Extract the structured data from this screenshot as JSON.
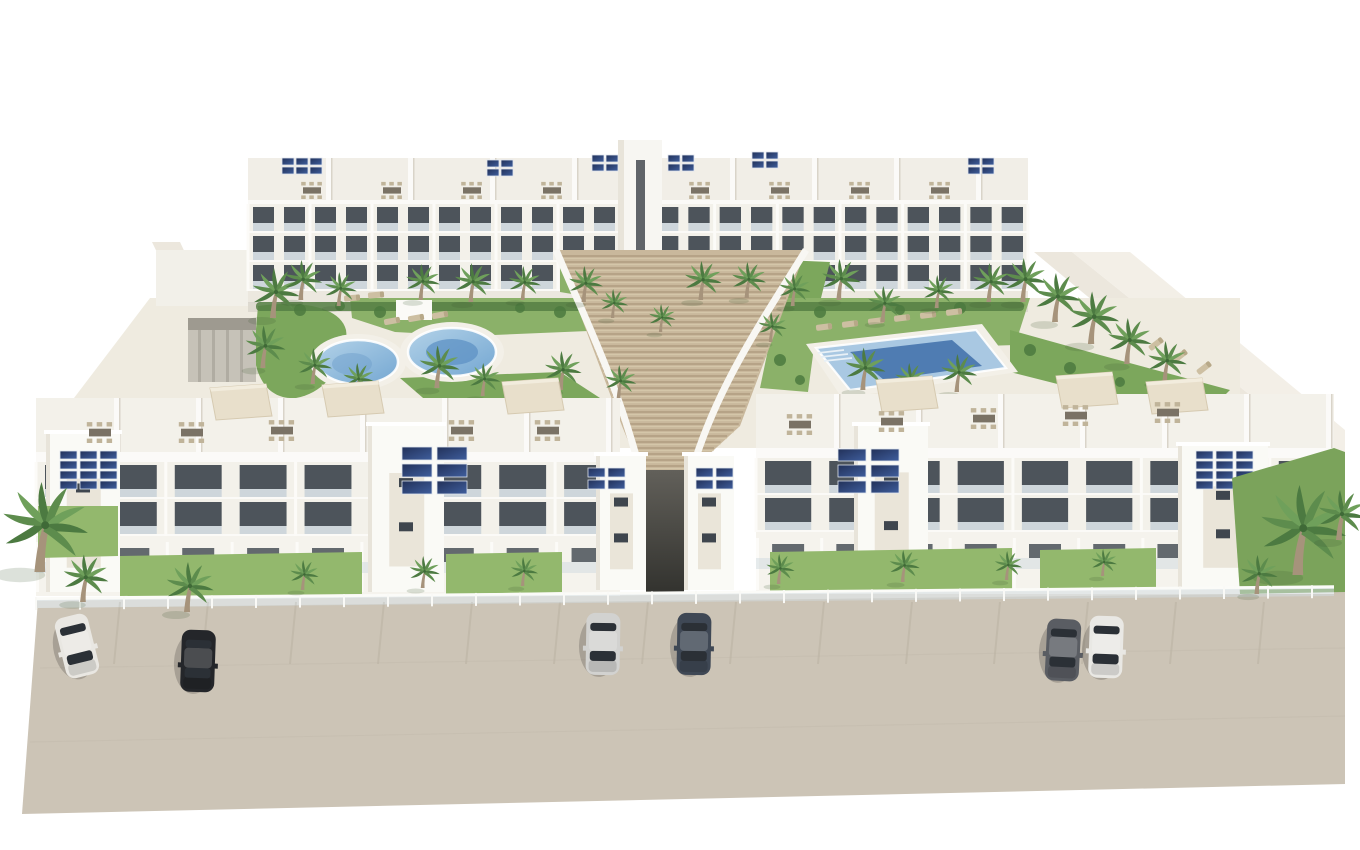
{
  "meta": {
    "type": "architectural-3d-render",
    "description": "Aerial render of a white Mediterranean apartment complex: two rear blocks with balconies and rooftop terraces, central timber stair cascade, kidney pool and rectangular pool in palm gardens, front blocks with rooftop dining terraces and solar panels, tan street with parked cars."
  },
  "palette": {
    "background": "#ffffff",
    "road": "#ccc4b6",
    "sidewalk": "#e4dfd4",
    "courtyard": "#efebe0",
    "building_white": "#f3f1ea",
    "building_bright": "#fbfaf7",
    "building_shade": "#e8e4da",
    "window_dark": "#3f464e",
    "glass_rail": "#c4cfd7",
    "beige_panel": "#ddd3c1",
    "timber": "#c9b89c",
    "timber_gap": "#aa967a",
    "grass": "#93b86d",
    "garden_green": "#7ca75c",
    "bush_dark": "#4c7a3f",
    "palm_trunk": "#a6937b",
    "pool_water": "#a9c8e2",
    "pool_deep": "#4f7cb2",
    "solar_dark": "#223159",
    "furniture_tan": "#c0b49a"
  },
  "scene": {
    "cars": [
      {
        "x": 77,
        "y": 646,
        "angle": -14,
        "color": "#e9e7e2"
      },
      {
        "x": 198,
        "y": 661,
        "angle": 2,
        "color": "#24262a"
      },
      {
        "x": 603,
        "y": 644,
        "angle": 1,
        "color": "#d2d2d0"
      },
      {
        "x": 694,
        "y": 644,
        "angle": 1,
        "color": "#3f4855"
      },
      {
        "x": 1063,
        "y": 650,
        "angle": 3,
        "color": "#5a5d63"
      },
      {
        "x": 1106,
        "y": 647,
        "angle": 2,
        "color": "#e9e8e4"
      }
    ],
    "palms_back": [
      [
        272,
        318,
        1.0
      ],
      [
        300,
        300,
        0.8
      ],
      [
        338,
        306,
        0.68
      ],
      [
        262,
        368,
        0.85
      ],
      [
        312,
        384,
        0.72
      ],
      [
        356,
        396,
        0.66
      ],
      [
        420,
        300,
        0.72
      ],
      [
        470,
        302,
        0.78
      ],
      [
        522,
        300,
        0.68
      ],
      [
        583,
        302,
        0.72
      ],
      [
        612,
        318,
        0.58
      ],
      [
        436,
        388,
        0.85
      ],
      [
        482,
        396,
        0.66
      ],
      [
        560,
        390,
        0.78
      ],
      [
        618,
        398,
        0.66
      ],
      [
        700,
        300,
        0.78
      ],
      [
        746,
        298,
        0.72
      ],
      [
        792,
        306,
        0.66
      ],
      [
        838,
        300,
        0.82
      ],
      [
        882,
        322,
        0.72
      ],
      [
        936,
        308,
        0.66
      ],
      [
        988,
        302,
        0.78
      ],
      [
        862,
        390,
        0.85
      ],
      [
        908,
        396,
        0.66
      ],
      [
        956,
        392,
        0.76
      ],
      [
        1022,
        302,
        0.88
      ],
      [
        1054,
        322,
        0.98
      ],
      [
        1090,
        344,
        1.05
      ],
      [
        1126,
        364,
        0.92
      ],
      [
        1164,
        382,
        0.82
      ],
      [
        660,
        332,
        0.56
      ],
      [
        770,
        342,
        0.6
      ]
    ],
    "palms_front": [
      [
        38,
        572,
        1.8
      ],
      [
        82,
        602,
        0.95
      ],
      [
        186,
        612,
        1.0
      ],
      [
        302,
        590,
        0.6
      ],
      [
        422,
        588,
        0.64
      ],
      [
        522,
        586,
        0.58
      ],
      [
        778,
        584,
        0.6
      ],
      [
        902,
        582,
        0.64
      ],
      [
        1006,
        580,
        0.58
      ],
      [
        1102,
        576,
        0.54
      ],
      [
        1296,
        575,
        1.8
      ],
      [
        1338,
        540,
        1.0
      ],
      [
        1256,
        594,
        0.78
      ]
    ],
    "solar_arrays": [
      {
        "layer": "front",
        "x": 60,
        "y": 451,
        "cols": 3,
        "rows": 4,
        "pw": 17,
        "ph": 8,
        "gx": 3,
        "gy": 2
      },
      {
        "layer": "front",
        "x": 402,
        "y": 447,
        "cols": 2,
        "rows": 3,
        "pw": 30,
        "ph": 13,
        "gx": 5,
        "gy": 4
      },
      {
        "layer": "front",
        "x": 588,
        "y": 468,
        "cols": 2,
        "rows": 2,
        "pw": 17,
        "ph": 9,
        "gx": 3,
        "gy": 3
      },
      {
        "layer": "front",
        "x": 696,
        "y": 468,
        "cols": 2,
        "rows": 2,
        "pw": 17,
        "ph": 9,
        "gx": 3,
        "gy": 3
      },
      {
        "layer": "front",
        "x": 838,
        "y": 449,
        "cols": 2,
        "rows": 3,
        "pw": 28,
        "ph": 12,
        "gx": 5,
        "gy": 4
      },
      {
        "layer": "front",
        "x": 1196,
        "y": 451,
        "cols": 3,
        "rows": 4,
        "pw": 17,
        "ph": 8,
        "gx": 3,
        "gy": 2
      },
      {
        "layer": "back",
        "x": 282,
        "y": 158,
        "cols": 3,
        "rows": 2,
        "pw": 12,
        "ph": 7,
        "gx": 2,
        "gy": 2
      },
      {
        "layer": "back",
        "x": 487,
        "y": 160,
        "cols": 2,
        "rows": 2,
        "pw": 12,
        "ph": 7,
        "gx": 2,
        "gy": 2
      },
      {
        "layer": "back",
        "x": 592,
        "y": 155,
        "cols": 2,
        "rows": 2,
        "pw": 12,
        "ph": 7,
        "gx": 2,
        "gy": 2
      },
      {
        "layer": "back",
        "x": 668,
        "y": 155,
        "cols": 2,
        "rows": 2,
        "pw": 12,
        "ph": 7,
        "gx": 2,
        "gy": 2
      },
      {
        "layer": "back",
        "x": 752,
        "y": 152,
        "cols": 2,
        "rows": 2,
        "pw": 12,
        "ph": 7,
        "gx": 2,
        "gy": 2
      },
      {
        "layer": "back",
        "x": 968,
        "y": 158,
        "cols": 2,
        "rows": 2,
        "pw": 12,
        "ph": 7,
        "gx": 2,
        "gy": 2
      }
    ],
    "dining_back": [
      [
        312,
        190
      ],
      [
        392,
        190
      ],
      [
        472,
        190
      ],
      [
        552,
        190
      ],
      [
        700,
        190
      ],
      [
        780,
        190
      ],
      [
        860,
        190
      ],
      [
        940,
        190
      ]
    ],
    "dining_front": [
      [
        100,
        432
      ],
      [
        192,
        432
      ],
      [
        282,
        430
      ],
      [
        462,
        430
      ],
      [
        548,
        430
      ],
      [
        800,
        424
      ],
      [
        892,
        421
      ],
      [
        984,
        418
      ],
      [
        1076,
        415
      ],
      [
        1168,
        412
      ]
    ],
    "pergolas": [
      [
        352,
        401
      ],
      [
        532,
        398
      ],
      [
        240,
        404
      ],
      [
        906,
        396
      ],
      [
        1086,
        392
      ],
      [
        1176,
        398
      ]
    ],
    "loungers": [
      [
        392,
        321,
        -10
      ],
      [
        416,
        318,
        -10
      ],
      [
        440,
        315,
        -10
      ],
      [
        352,
        298,
        -5
      ],
      [
        376,
        295,
        -5
      ],
      [
        824,
        327,
        -7
      ],
      [
        850,
        324,
        -7
      ],
      [
        876,
        321,
        -7
      ],
      [
        902,
        318,
        -7
      ],
      [
        928,
        315,
        -7
      ],
      [
        954,
        312,
        -7
      ],
      [
        1156,
        344,
        -38
      ],
      [
        1180,
        356,
        -38
      ],
      [
        1204,
        368,
        -38
      ]
    ],
    "buildings": [
      {
        "name": "back-left",
        "group": "back-facades",
        "x": 248,
        "y": 204,
        "w": 372,
        "floors": 3,
        "fh": 29,
        "bays": 12,
        "pier": 5,
        "openH": 16,
        "railH": 8
      },
      {
        "name": "back-right",
        "group": "back-facades",
        "x": 652,
        "y": 204,
        "w": 376,
        "floors": 3,
        "fh": 29,
        "bays": 12,
        "pier": 5,
        "openH": 16,
        "railH": 8
      },
      {
        "name": "front-left",
        "group": "front-facades",
        "x": 36,
        "y": 462,
        "w": 584,
        "floors": 2,
        "fh": 37,
        "bays": 9,
        "pier": 9,
        "openH": 24,
        "railH": 9,
        "groundH": 60
      },
      {
        "name": "front-right",
        "group": "front-facades",
        "x": 756,
        "y": 458,
        "w": 578,
        "floors": 2,
        "fh": 37,
        "bays": 9,
        "pier": 9,
        "openH": 24,
        "railH": 9,
        "groundH": 62
      }
    ],
    "towers": [
      [
        46,
        430,
        74,
        162
      ],
      [
        368,
        422,
        76,
        170
      ],
      [
        596,
        452,
        50,
        138
      ],
      [
        684,
        452,
        50,
        138
      ],
      [
        854,
        422,
        74,
        168
      ],
      [
        1178,
        442,
        90,
        148
      ]
    ],
    "stairs": {
      "yTop": 250,
      "yMid": 426,
      "yBot": 470,
      "xTopL": 556,
      "xTopR": 806,
      "xMidL": 622,
      "xMidR": 740,
      "xBotL": 640,
      "xBotR": 692,
      "step": 6
    },
    "fence": {
      "x1": 36,
      "x2": 1334,
      "y1": 599,
      "y2": 587,
      "postGap": 44
    },
    "parking_ticks": {
      "x0": 120,
      "x1": 1300,
      "gap": 88,
      "yTop": 602,
      "len": 62
    }
  }
}
